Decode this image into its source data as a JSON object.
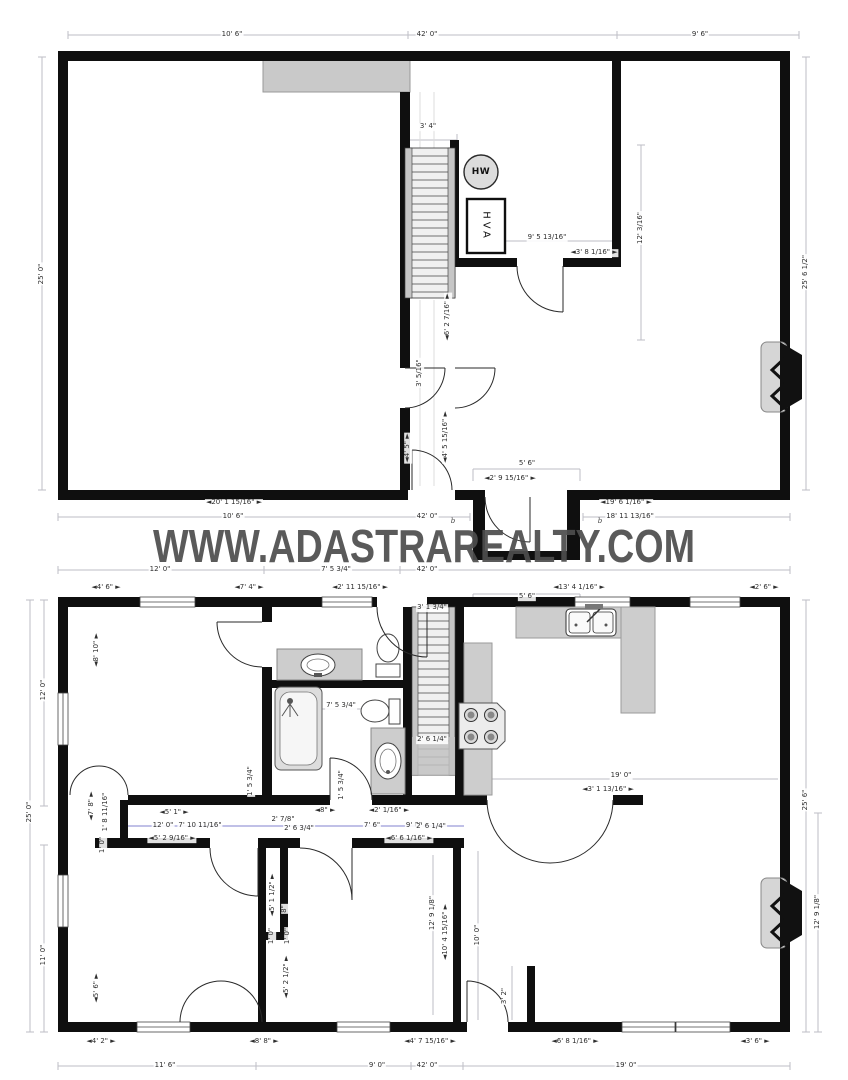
{
  "watermark": {
    "text": "WWW.ADASTRAREALTY.COM"
  },
  "colors": {
    "wall": "#0f0f0f",
    "gray_fill": "#cccccc",
    "dim_line": "#bdbdc5",
    "dim_text": "#2e2e2e",
    "watermark": "#4d4d4d",
    "hall_dim_blue": "#8080cf"
  },
  "plans": {
    "upper": {
      "name": "upper-floor-plan",
      "labels": [
        {
          "t": "10' 6\"",
          "x": 232,
          "y": 35
        },
        {
          "t": "42' 0\"",
          "x": 427,
          "y": 35
        },
        {
          "t": "9' 6\"",
          "x": 700,
          "y": 35
        },
        {
          "t": "3' 4\"",
          "x": 428,
          "y": 127
        },
        {
          "t": "HW",
          "x": 481,
          "y": 172,
          "cls": "hw"
        },
        {
          "t": "HVA",
          "x": 486,
          "y": 226,
          "cls": "hva"
        },
        {
          "t": "12' 3/16\"",
          "x": 641,
          "y": 228,
          "r": 1
        },
        {
          "t": "9' 5 13/16\"",
          "x": 547,
          "y": 238
        },
        {
          "t": "◄3' 8 1/16\" ►",
          "x": 594,
          "y": 253
        },
        {
          "t": "◄6' 2 7/16\" ►",
          "x": 448,
          "y": 317,
          "r": 1
        },
        {
          "t": "3' 5/16\"",
          "x": 420,
          "y": 373,
          "r": 1
        },
        {
          "t": "25' 0\"",
          "x": 42,
          "y": 274,
          "r": 1
        },
        {
          "t": "25' 6 1/2\"",
          "x": 806,
          "y": 272,
          "r": 1
        },
        {
          "t": "◄4' 5\" ►",
          "x": 408,
          "y": 448,
          "r": 1
        },
        {
          "t": "◄4' 5 15/16\" ►",
          "x": 446,
          "y": 437,
          "r": 1
        },
        {
          "t": "5' 6\"",
          "x": 527,
          "y": 464
        },
        {
          "t": "◄2' 9 15/16\" ►",
          "x": 510,
          "y": 479
        },
        {
          "t": "◄20' 1 15/16\" ►",
          "x": 234,
          "y": 503
        },
        {
          "t": "10' 6\"",
          "x": 233,
          "y": 517
        },
        {
          "t": "42' 0\"",
          "x": 427,
          "y": 517
        },
        {
          "t": "◄19' 6 1/16\" ►",
          "x": 626,
          "y": 503
        },
        {
          "t": "18' 11 13/16\"",
          "x": 630,
          "y": 517
        },
        {
          "t": "b",
          "x": 453,
          "y": 521,
          "cls": "b"
        },
        {
          "t": "b",
          "x": 600,
          "y": 521,
          "cls": "b"
        }
      ]
    },
    "lower": {
      "name": "main-floor-plan",
      "labels": [
        {
          "t": "12' 0\"",
          "x": 160,
          "y": 570
        },
        {
          "t": "7' 5 3/4\"",
          "x": 336,
          "y": 570
        },
        {
          "t": "42' 0\"",
          "x": 427,
          "y": 570
        },
        {
          "t": "◄4' 6\" ►",
          "x": 106,
          "y": 588
        },
        {
          "t": "◄7' 4\" ►",
          "x": 249,
          "y": 588
        },
        {
          "t": "◄2' 11 15/16\" ►",
          "x": 360,
          "y": 588
        },
        {
          "t": "5' 6\"",
          "x": 527,
          "y": 597
        },
        {
          "t": "◄13' 4 1/16\" ►",
          "x": 579,
          "y": 588
        },
        {
          "t": "◄2' 6\" ►",
          "x": 764,
          "y": 588
        },
        {
          "t": "3' 1 3/4\"",
          "x": 432,
          "y": 608
        },
        {
          "t": "◄8' 10\" ►",
          "x": 97,
          "y": 650,
          "r": 1
        },
        {
          "t": "12' 0\"",
          "x": 44,
          "y": 690,
          "r": 1
        },
        {
          "t": "25' 0\"",
          "x": 30,
          "y": 812,
          "r": 1
        },
        {
          "t": "◄7' 8\" ►",
          "x": 92,
          "y": 806,
          "r": 1
        },
        {
          "t": "1' 8 11/16\"",
          "x": 106,
          "y": 812,
          "r": 1
        },
        {
          "t": "1' 0\"",
          "x": 103,
          "y": 845,
          "r": 1
        },
        {
          "t": "11' 0\"",
          "x": 44,
          "y": 955,
          "r": 1
        },
        {
          "t": "◄5' 6\" ►",
          "x": 97,
          "y": 988,
          "r": 1
        },
        {
          "t": "◄5' 1\" ►",
          "x": 174,
          "y": 813
        },
        {
          "t": "12' 0\"",
          "x": 163,
          "y": 826
        },
        {
          "t": "7' 10 11/16\"",
          "x": 200,
          "y": 826
        },
        {
          "t": "◄5' 2 9/16\" ►",
          "x": 172,
          "y": 839
        },
        {
          "t": "2' 7/8\"",
          "x": 283,
          "y": 820
        },
        {
          "t": "2' 6 3/4\"",
          "x": 299,
          "y": 829
        },
        {
          "t": "◄8\" ►",
          "x": 325,
          "y": 811
        },
        {
          "t": "◄2' 1/16\" ►",
          "x": 389,
          "y": 811
        },
        {
          "t": "7' 6\"",
          "x": 372,
          "y": 826
        },
        {
          "t": "9' 0\"",
          "x": 414,
          "y": 826
        },
        {
          "t": "◄6' 6 1/16\" ►",
          "x": 409,
          "y": 839
        },
        {
          "t": "2' 6 1/4\"",
          "x": 431,
          "y": 827
        },
        {
          "t": "1' 5 3/4\"",
          "x": 251,
          "y": 781,
          "r": 1
        },
        {
          "t": "1' 5 3/4\"",
          "x": 342,
          "y": 785,
          "r": 1
        },
        {
          "t": "7' 5 3/4\"",
          "x": 341,
          "y": 706
        },
        {
          "t": "2' 6 1/4\"",
          "x": 432,
          "y": 740
        },
        {
          "t": "19' 0\"",
          "x": 621,
          "y": 776
        },
        {
          "t": "◄3' 1 13/16\" ►",
          "x": 608,
          "y": 790
        },
        {
          "t": "◄5' 1 1/2\" ►",
          "x": 273,
          "y": 895,
          "r": 1
        },
        {
          "t": "8\"",
          "x": 285,
          "y": 909,
          "r": 1
        },
        {
          "t": "1' 0\"",
          "x": 272,
          "y": 936,
          "r": 1
        },
        {
          "t": "1' 0\"",
          "x": 288,
          "y": 936,
          "r": 1
        },
        {
          "t": "◄5' 2 1/2\" ►",
          "x": 287,
          "y": 977,
          "r": 1
        },
        {
          "t": "12' 9 1/8\"",
          "x": 433,
          "y": 913,
          "r": 1
        },
        {
          "t": "◄10' 4 15/16\" ►",
          "x": 446,
          "y": 932,
          "r": 1
        },
        {
          "t": "10' 0\"",
          "x": 478,
          "y": 935,
          "r": 1
        },
        {
          "t": "3' 2\"",
          "x": 505,
          "y": 996,
          "r": 1
        },
        {
          "t": "25' 6\"",
          "x": 806,
          "y": 800,
          "r": 1
        },
        {
          "t": "12' 9 1/8\"",
          "x": 818,
          "y": 912,
          "r": 1
        },
        {
          "t": "◄4' 2\" ►",
          "x": 101,
          "y": 1042
        },
        {
          "t": "◄8' 8\" ►",
          "x": 264,
          "y": 1042
        },
        {
          "t": "◄4' 7 15/16\" ►",
          "x": 430,
          "y": 1042
        },
        {
          "t": "◄6' 8 1/16\" ►",
          "x": 575,
          "y": 1042
        },
        {
          "t": "◄3' 6\" ►",
          "x": 755,
          "y": 1042
        },
        {
          "t": "11' 6\"",
          "x": 165,
          "y": 1066
        },
        {
          "t": "9' 0\"",
          "x": 377,
          "y": 1066
        },
        {
          "t": "42' 0\"",
          "x": 427,
          "y": 1066
        },
        {
          "t": "19' 0\"",
          "x": 626,
          "y": 1066
        }
      ]
    }
  }
}
